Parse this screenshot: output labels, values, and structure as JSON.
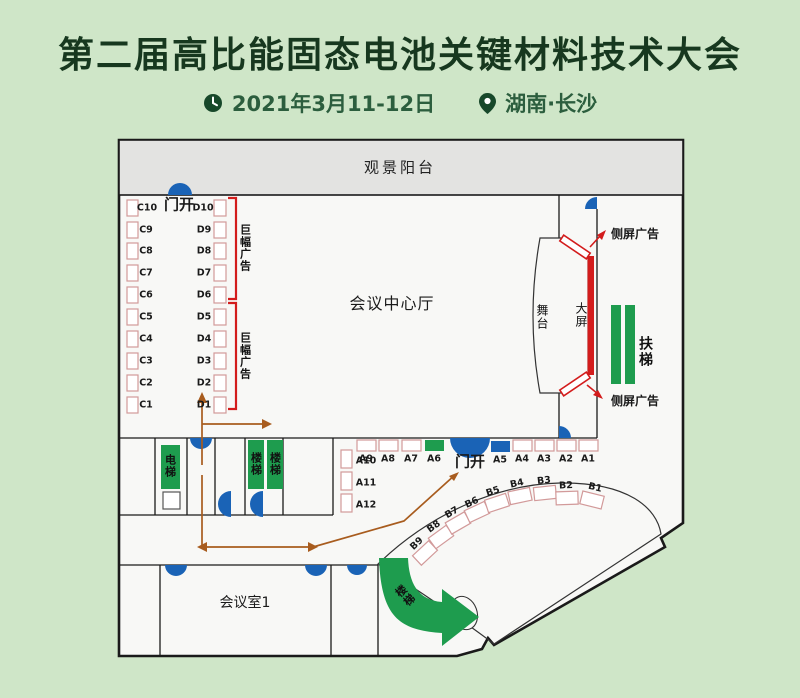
{
  "header": {
    "title": "第二届高比能固态电池关键材料技术大会",
    "date": "2021年3月11-12日",
    "location": "湖南·长沙"
  },
  "plan": {
    "balcony": "观景阳台",
    "door_open_top": "门开",
    "door_open_main": "门开",
    "hall": "会议中心厅",
    "stage": "舞台",
    "big_screen": "大屏",
    "side_ad_top": "侧屏广告",
    "side_ad_bottom": "侧屏广告",
    "banner_ad_top": "巨幅广告",
    "banner_ad_bottom": "巨幅广告",
    "escalator": "扶梯",
    "elevator": "电梯",
    "stairs_bar_left": "楼梯",
    "stairs_bar_right": "楼梯",
    "stairs_curve": "楼梯",
    "meeting_room": "会议室1",
    "booths": {
      "c": [
        "C10",
        "C9",
        "C8",
        "C7",
        "C6",
        "C5",
        "C4",
        "C3",
        "C2",
        "C1"
      ],
      "d": [
        "D10",
        "D9",
        "D8",
        "D7",
        "D6",
        "D5",
        "D4",
        "D3",
        "D2",
        "D1"
      ],
      "a_top": [
        "A9",
        "A8",
        "A7",
        "A6",
        "A5",
        "A4",
        "A3",
        "A2",
        "A1"
      ],
      "a_side": [
        "A10",
        "A11",
        "A12"
      ],
      "b": [
        "B9",
        "B8",
        "B7",
        "B6",
        "B5",
        "B4",
        "B3",
        "B2",
        "B1"
      ]
    },
    "colors": {
      "background": "#cfe6c8",
      "floor": "#f8f8f6",
      "balcony_gray": "#e3e3e1",
      "door_blue": "#1a63b6",
      "facility_green": "#1e9c4e",
      "booth_outline_pink": "#d29a9a",
      "signal_red": "#d31c1c",
      "route_orange": "#a85c1e",
      "title_green": "#17381f"
    }
  }
}
